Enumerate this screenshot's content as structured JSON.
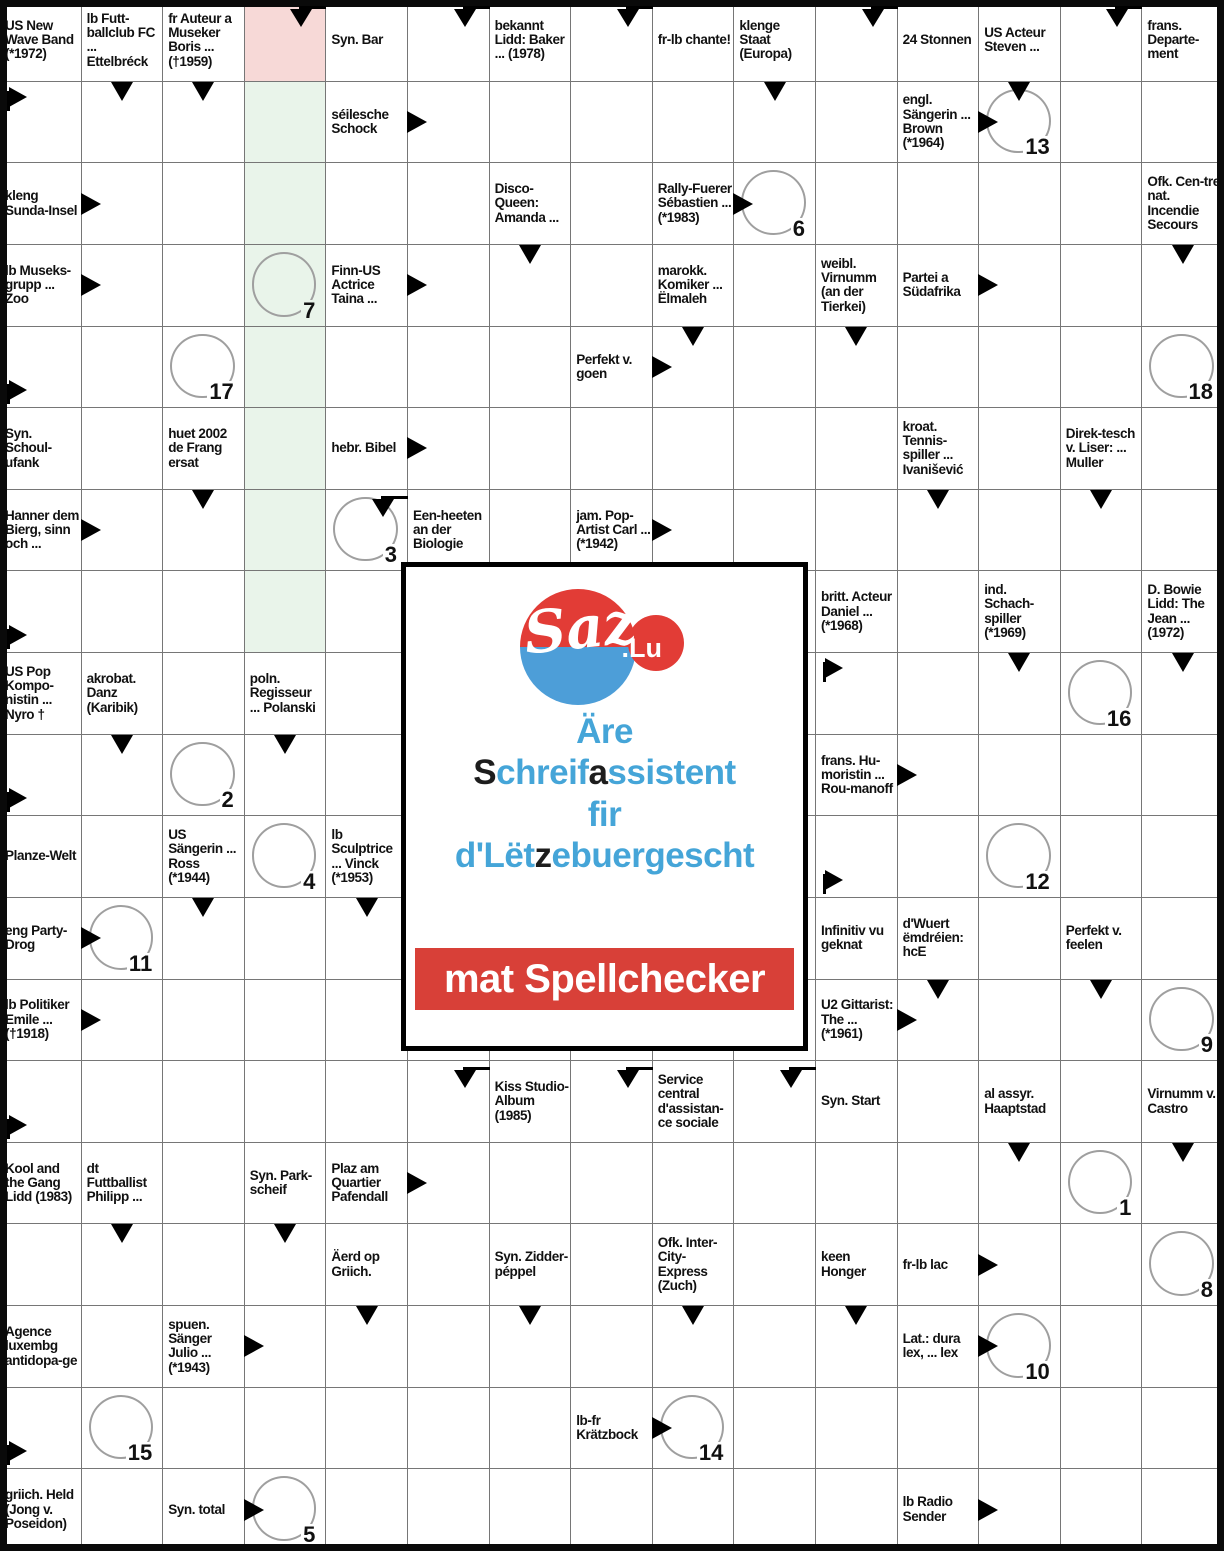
{
  "puzzle": {
    "cols": 15,
    "rows": 19,
    "colors": {
      "grid_line": "#767676",
      "outer_border": "#0a0a0a",
      "pink_cell": "#f7d9d7",
      "green_cell": "#e9f4ea",
      "circle_stroke": "#9f9f9f"
    },
    "cells": [
      {
        "r": 1,
        "c": 1,
        "t": "US New Wave Band (*1972)"
      },
      {
        "r": 1,
        "c": 2,
        "t": "lb Futt-ballclub FC ... Ettelbréck"
      },
      {
        "r": 1,
        "c": 3,
        "t": "fr Auteur a Museker Boris ... (†1959)"
      },
      {
        "r": 1,
        "c": 4,
        "bg": "pink",
        "m": [
          "bentDown"
        ]
      },
      {
        "r": 1,
        "c": 5,
        "t": "Syn. Bar"
      },
      {
        "r": 1,
        "c": 6,
        "m": [
          "bentDown"
        ]
      },
      {
        "r": 1,
        "c": 7,
        "t": "bekannt Lidd: Baker ... (1978)"
      },
      {
        "r": 1,
        "c": 8,
        "m": [
          "bentDown"
        ]
      },
      {
        "r": 1,
        "c": 9,
        "t": "fr-lb chante!"
      },
      {
        "r": 1,
        "c": 10,
        "t": "klenge Staat (Europa)"
      },
      {
        "r": 1,
        "c": 11,
        "m": [
          "bentDown"
        ]
      },
      {
        "r": 1,
        "c": 12,
        "t": "24 Stonnen"
      },
      {
        "r": 1,
        "c": 13,
        "t": "US Acteur Steven ..."
      },
      {
        "r": 1,
        "c": 14,
        "m": [
          "bentDown"
        ]
      },
      {
        "r": 1,
        "c": 15,
        "t": "frans. Departe-ment"
      },
      {
        "r": 2,
        "c": 1,
        "m": [
          "flagTop"
        ]
      },
      {
        "r": 2,
        "c": 2,
        "m": [
          "down"
        ]
      },
      {
        "r": 2,
        "c": 3,
        "m": [
          "down"
        ]
      },
      {
        "r": 2,
        "c": 4,
        "bg": "green"
      },
      {
        "r": 2,
        "c": 5,
        "t": "séilesche Schock"
      },
      {
        "r": 2,
        "c": 6,
        "m": [
          "rightIn"
        ]
      },
      {
        "r": 2,
        "c": 10,
        "m": [
          "down"
        ]
      },
      {
        "r": 2,
        "c": 12,
        "t": "engl. Sängerin ... Brown (*1964)"
      },
      {
        "r": 2,
        "c": 13,
        "circle": "13",
        "m": [
          "down",
          "rightIn"
        ]
      },
      {
        "r": 3,
        "c": 1,
        "t": "kleng Sunda-Insel"
      },
      {
        "r": 3,
        "c": 2,
        "m": [
          "rightIn"
        ]
      },
      {
        "r": 3,
        "c": 4,
        "bg": "green"
      },
      {
        "r": 3,
        "c": 7,
        "t": "Disco-Queen: Amanda ..."
      },
      {
        "r": 3,
        "c": 9,
        "t": "Rally-Fuerer Sébastien ... (*1983)"
      },
      {
        "r": 3,
        "c": 10,
        "circle": "6",
        "m": [
          "rightIn"
        ]
      },
      {
        "r": 3,
        "c": 15,
        "t": "Ofk. Cen-tre nat. Incendie Secours"
      },
      {
        "r": 4,
        "c": 1,
        "t": "lb Museks-grupp ... Zoo"
      },
      {
        "r": 4,
        "c": 2,
        "m": [
          "rightIn"
        ]
      },
      {
        "r": 4,
        "c": 4,
        "bg": "green",
        "circle": "7"
      },
      {
        "r": 4,
        "c": 5,
        "t": "Finn-US Actrice Taina ..."
      },
      {
        "r": 4,
        "c": 6,
        "m": [
          "rightIn"
        ]
      },
      {
        "r": 4,
        "c": 7,
        "m": [
          "down"
        ]
      },
      {
        "r": 4,
        "c": 9,
        "t": "marokk. Komiker ... Ëlmaleh"
      },
      {
        "r": 4,
        "c": 11,
        "t": "weibl. Virnumm (an der Tierkei)"
      },
      {
        "r": 4,
        "c": 12,
        "t": "Partei a Südafrika"
      },
      {
        "r": 4,
        "c": 13,
        "m": [
          "rightIn"
        ]
      },
      {
        "r": 4,
        "c": 15,
        "m": [
          "down"
        ]
      },
      {
        "r": 5,
        "c": 1,
        "m": [
          "flagBottom"
        ]
      },
      {
        "r": 5,
        "c": 3,
        "circle": "17"
      },
      {
        "r": 5,
        "c": 4,
        "bg": "green"
      },
      {
        "r": 5,
        "c": 8,
        "t": "Perfekt v. goen"
      },
      {
        "r": 5,
        "c": 9,
        "m": [
          "down",
          "rightIn"
        ]
      },
      {
        "r": 5,
        "c": 11,
        "m": [
          "down"
        ]
      },
      {
        "r": 5,
        "c": 15,
        "circle": "18"
      },
      {
        "r": 6,
        "c": 1,
        "t": "Syn. Schoul-ufank"
      },
      {
        "r": 6,
        "c": 3,
        "t": "huet 2002 de Frang ersat"
      },
      {
        "r": 6,
        "c": 4,
        "bg": "green"
      },
      {
        "r": 6,
        "c": 5,
        "t": "hebr. Bibel"
      },
      {
        "r": 6,
        "c": 6,
        "m": [
          "rightIn"
        ]
      },
      {
        "r": 6,
        "c": 12,
        "t": "kroat. Tennis-spiller ... Ivanišević"
      },
      {
        "r": 6,
        "c": 14,
        "t": "Direk-tesch v. Liser: ... Muller"
      },
      {
        "r": 7,
        "c": 1,
        "t": "Hanner dem Bierg, sinn och ..."
      },
      {
        "r": 7,
        "c": 2,
        "m": [
          "rightIn"
        ]
      },
      {
        "r": 7,
        "c": 3,
        "m": [
          "down"
        ]
      },
      {
        "r": 7,
        "c": 4,
        "bg": "green"
      },
      {
        "r": 7,
        "c": 5,
        "circle": "3",
        "m": [
          "bentDown"
        ]
      },
      {
        "r": 7,
        "c": 6,
        "t": "Een-heeten an der Biologie"
      },
      {
        "r": 7,
        "c": 8,
        "t": "jam. Pop-Artist Carl ... (*1942)"
      },
      {
        "r": 7,
        "c": 9,
        "m": [
          "rightIn"
        ]
      },
      {
        "r": 7,
        "c": 12,
        "m": [
          "down"
        ]
      },
      {
        "r": 7,
        "c": 14,
        "m": [
          "down"
        ]
      },
      {
        "r": 8,
        "c": 1,
        "m": [
          "flagBottom"
        ]
      },
      {
        "r": 8,
        "c": 4,
        "bg": "green"
      },
      {
        "r": 8,
        "c": 11,
        "t": "britt. Acteur Daniel ... (*1968)"
      },
      {
        "r": 8,
        "c": 13,
        "t": "ind. Schach-spiller (*1969)"
      },
      {
        "r": 8,
        "c": 15,
        "t": "D. Bowie Lidd: The Jean ... (1972)"
      },
      {
        "r": 9,
        "c": 1,
        "t": "US Pop Kompo-nistin ... Nyro †"
      },
      {
        "r": 9,
        "c": 2,
        "t": "akrobat. Danz (Karibik)"
      },
      {
        "r": 9,
        "c": 4,
        "t": "poln. Regisseur ... Polanski"
      },
      {
        "r": 9,
        "c": 11,
        "m": [
          "flagTop"
        ]
      },
      {
        "r": 9,
        "c": 13,
        "m": [
          "down"
        ]
      },
      {
        "r": 9,
        "c": 14,
        "circle": "16"
      },
      {
        "r": 9,
        "c": 15,
        "m": [
          "down"
        ]
      },
      {
        "r": 10,
        "c": 1,
        "m": [
          "flagBottom"
        ]
      },
      {
        "r": 10,
        "c": 2,
        "m": [
          "down"
        ]
      },
      {
        "r": 10,
        "c": 3,
        "circle": "2"
      },
      {
        "r": 10,
        "c": 4,
        "m": [
          "down"
        ]
      },
      {
        "r": 10,
        "c": 11,
        "t": "frans. Hu-moristin ... Rou-manoff"
      },
      {
        "r": 10,
        "c": 12,
        "m": [
          "rightIn"
        ]
      },
      {
        "r": 11,
        "c": 1,
        "t": "Planze-Welt"
      },
      {
        "r": 11,
        "c": 3,
        "t": "US Sängerin ... Ross (*1944)"
      },
      {
        "r": 11,
        "c": 4,
        "circle": "4"
      },
      {
        "r": 11,
        "c": 5,
        "t": "lb Sculptrice ... Vinck (*1953)"
      },
      {
        "r": 11,
        "c": 11,
        "m": [
          "flagBottom"
        ]
      },
      {
        "r": 11,
        "c": 13,
        "circle": "12"
      },
      {
        "r": 12,
        "c": 1,
        "t": "eng Party-Drog"
      },
      {
        "r": 12,
        "c": 2,
        "circle": "11",
        "m": [
          "rightIn"
        ]
      },
      {
        "r": 12,
        "c": 3,
        "m": [
          "down"
        ]
      },
      {
        "r": 12,
        "c": 5,
        "m": [
          "down"
        ]
      },
      {
        "r": 12,
        "c": 11,
        "t": "Infinitiv vu geknat"
      },
      {
        "r": 12,
        "c": 12,
        "t": "d'Wuert ëmdréien: hcE"
      },
      {
        "r": 12,
        "c": 14,
        "t": "Perfekt v. feelen"
      },
      {
        "r": 13,
        "c": 1,
        "t": "lb Politiker Emile ... (†1918)"
      },
      {
        "r": 13,
        "c": 2,
        "m": [
          "rightIn"
        ]
      },
      {
        "r": 13,
        "c": 11,
        "t": "U2 Gittarist: The ... (*1961)"
      },
      {
        "r": 13,
        "c": 12,
        "m": [
          "down",
          "rightIn"
        ]
      },
      {
        "r": 13,
        "c": 14,
        "m": [
          "down"
        ]
      },
      {
        "r": 13,
        "c": 15,
        "circle": "9"
      },
      {
        "r": 14,
        "c": 1,
        "m": [
          "flagBottom"
        ]
      },
      {
        "r": 14,
        "c": 6,
        "m": [
          "bentDown"
        ]
      },
      {
        "r": 14,
        "c": 7,
        "t": "Kiss Studio-Album (1985)"
      },
      {
        "r": 14,
        "c": 8,
        "m": [
          "bentDown"
        ]
      },
      {
        "r": 14,
        "c": 9,
        "t": "Service central d'assistan-ce sociale"
      },
      {
        "r": 14,
        "c": 10,
        "m": [
          "bentDown"
        ]
      },
      {
        "r": 14,
        "c": 11,
        "t": "Syn. Start"
      },
      {
        "r": 14,
        "c": 13,
        "t": "al assyr. Haaptstad"
      },
      {
        "r": 14,
        "c": 15,
        "t": "Virnumm v. Castro"
      },
      {
        "r": 15,
        "c": 1,
        "t": "Kool and the Gang Lidd (1983)"
      },
      {
        "r": 15,
        "c": 2,
        "t": "dt Futtballist Philipp ..."
      },
      {
        "r": 15,
        "c": 4,
        "t": "Syn. Park-scheif"
      },
      {
        "r": 15,
        "c": 5,
        "t": "Plaz am Quartier Pafendall"
      },
      {
        "r": 15,
        "c": 6,
        "m": [
          "rightIn"
        ]
      },
      {
        "r": 15,
        "c": 13,
        "m": [
          "down"
        ]
      },
      {
        "r": 15,
        "c": 14,
        "circle": "1"
      },
      {
        "r": 15,
        "c": 15,
        "m": [
          "down"
        ]
      },
      {
        "r": 16,
        "c": 2,
        "m": [
          "down"
        ]
      },
      {
        "r": 16,
        "c": 4,
        "m": [
          "down"
        ]
      },
      {
        "r": 16,
        "c": 5,
        "t": "Äerd op Griich."
      },
      {
        "r": 16,
        "c": 7,
        "t": "Syn. Zidder-péppel"
      },
      {
        "r": 16,
        "c": 9,
        "t": "Ofk. Inter-City-Express (Zuch)"
      },
      {
        "r": 16,
        "c": 11,
        "t": "keen Honger"
      },
      {
        "r": 16,
        "c": 12,
        "t": "fr-lb lac"
      },
      {
        "r": 16,
        "c": 13,
        "m": [
          "rightIn"
        ]
      },
      {
        "r": 16,
        "c": 15,
        "circle": "8"
      },
      {
        "r": 17,
        "c": 1,
        "t": "Agence luxembg antidopa-ge"
      },
      {
        "r": 17,
        "c": 3,
        "t": "spuen. Sänger Julio ... (*1943)"
      },
      {
        "r": 17,
        "c": 4,
        "m": [
          "rightIn"
        ]
      },
      {
        "r": 17,
        "c": 5,
        "m": [
          "down"
        ]
      },
      {
        "r": 17,
        "c": 7,
        "m": [
          "down"
        ]
      },
      {
        "r": 17,
        "c": 9,
        "m": [
          "down"
        ]
      },
      {
        "r": 17,
        "c": 11,
        "m": [
          "down"
        ]
      },
      {
        "r": 17,
        "c": 12,
        "t": "Lat.: dura lex, ... lex"
      },
      {
        "r": 17,
        "c": 13,
        "circle": "10",
        "m": [
          "rightIn"
        ]
      },
      {
        "r": 18,
        "c": 1,
        "m": [
          "flagBottom"
        ]
      },
      {
        "r": 18,
        "c": 2,
        "circle": "15"
      },
      {
        "r": 18,
        "c": 8,
        "t": "lb-fr Krätzbock"
      },
      {
        "r": 18,
        "c": 9,
        "circle": "14",
        "m": [
          "rightIn"
        ]
      },
      {
        "r": 19,
        "c": 1,
        "t": "griich. Held (Jong v. Poseidon)"
      },
      {
        "r": 19,
        "c": 3,
        "t": "Syn. total"
      },
      {
        "r": 19,
        "c": 4,
        "circle": "5",
        "m": [
          "rightIn"
        ]
      },
      {
        "r": 19,
        "c": 12,
        "t": "lb Radio Sender"
      },
      {
        "r": 19,
        "c": 13,
        "m": [
          "rightIn"
        ]
      }
    ]
  },
  "ad": {
    "logo_main": "Saz",
    "logo_suffix": ".Lu",
    "line1": "Äre",
    "line2_parts": [
      [
        "S",
        "dark"
      ],
      [
        "chreif",
        "blue"
      ],
      [
        "a",
        "dark"
      ],
      [
        "ssistent",
        "blue"
      ]
    ],
    "line3": "fir",
    "line4_parts": [
      [
        "d'Lët",
        "blue"
      ],
      [
        "z",
        "dark"
      ],
      [
        "ebuergescht",
        "blue"
      ]
    ],
    "banner": "mat Spellchecker",
    "colors": {
      "blue_text": "#45a5d8",
      "dark_text": "#1d1d1d",
      "banner_red": "#d84038",
      "logo_red": "#e23c36",
      "logo_blue": "#4d9ed8"
    }
  }
}
